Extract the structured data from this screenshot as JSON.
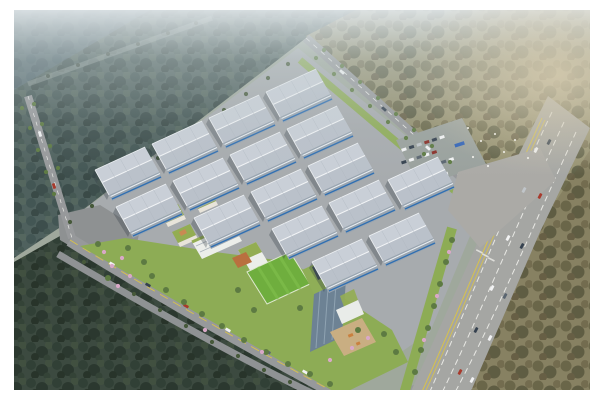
{
  "scene": {
    "description": "Aerial rendering of an industrial logistics park: rows of white warehouses, an office campus with a glass tower, green-roof buildings and a soccer field, bordered by forests, access roads and a multi-lane highway with traffic",
    "warehouse_count": 16,
    "regions": [
      "northwest-forest",
      "northeast-forest",
      "southeast-forest",
      "southwest-forest",
      "warehouse-grid",
      "office-campus",
      "soccer-field",
      "office-tower",
      "plaza",
      "parking-lot",
      "highway",
      "access-roads",
      "landscaping"
    ]
  },
  "colors": {
    "page_bg": "#ffffff",
    "base_ground": "#9fa89c",
    "nw_forest": "#4a594e",
    "ne_forest": "#94906f",
    "site_pavement": "#a7abae",
    "road": "#97999b",
    "road_faint": "#8d9a96",
    "junction": "#8e9192",
    "highway": "#a5a6a3",
    "intersection": "#abaaa6",
    "lane_marking": "#e8e8e4",
    "lane_yellow": "#d8c24a",
    "warehouse_roof": "#c9cfd7",
    "warehouse_roof_shade": "#b7bec8",
    "warehouse_ridge": "#f2f4f6",
    "warehouse_gable": "#d8dde2",
    "warehouse_facade": "#98a4b0",
    "warehouse_accent_blue": "#2f6fb2",
    "greenery": "#8dac55",
    "tree_green": "#5d7a42",
    "tree_dark": "#46593a",
    "blossom_pink": "#d9a8c7",
    "soccer_field": "#6fae3e",
    "field_stripe": "#7fbf4c",
    "campus_building": "#eceeea",
    "campus_roof_green": "#93ad52",
    "campus_accent_orange": "#c98a52",
    "courtyard_terracotta": "#b9703f",
    "tower_glass": "#6d8294",
    "tower_stripe": "#8fa3b2",
    "tower_roof": "#8fae57",
    "tower_helipad": "#46525a",
    "plaza_tan": "#c9ae82",
    "parking_lot": "#9aa19d",
    "car_white": "#f2f3f4",
    "car_dark": "#35414f",
    "car_red": "#a83a2c",
    "bus_blue": "#2f62b8",
    "bird_white": "#f5f4ef"
  }
}
